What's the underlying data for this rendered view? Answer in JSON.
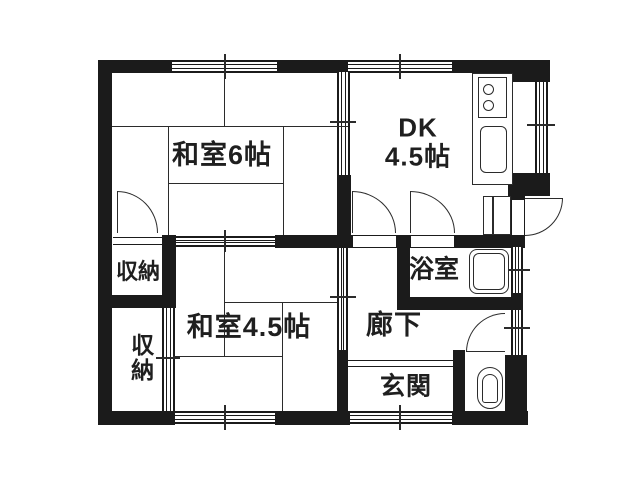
{
  "floorplan": {
    "type": "japanese-apartment-floor-plan",
    "rooms": {
      "washitsu6": {
        "label": "和室6帖"
      },
      "dk": {
        "label_line1": "DK",
        "label_line2": "4.5帖"
      },
      "washitsu45": {
        "label": "和室4.5帖"
      },
      "storage_upper": {
        "label": "収納"
      },
      "storage_lower": {
        "label": "収納"
      },
      "corridor": {
        "label": "廊下"
      },
      "bathroom": {
        "label": "浴室"
      },
      "entrance": {
        "label": "玄関"
      }
    },
    "fixtures": [
      "stove-2-burner",
      "kitchen-sink",
      "bathtub",
      "toilet"
    ],
    "colors": {
      "wall": "#1b1b1b",
      "line": "#2b2b2b",
      "text": "#1f1f1f",
      "background": "#ffffff"
    }
  }
}
